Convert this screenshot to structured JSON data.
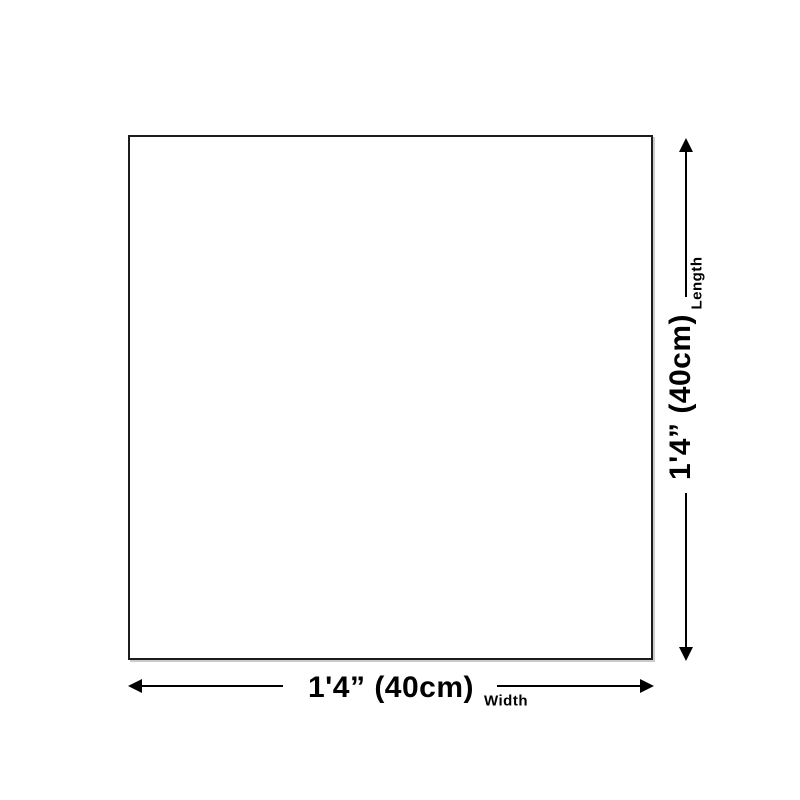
{
  "colors": {
    "background": "#ffffff",
    "square_outline": "#1c1c1c",
    "arrow": "#000000",
    "text": "#000000"
  },
  "dimensions": {
    "length": {
      "value": "1'4” (40cm)",
      "label": "Length"
    },
    "width": {
      "value": "1'4” (40cm)",
      "label": "Width"
    }
  }
}
